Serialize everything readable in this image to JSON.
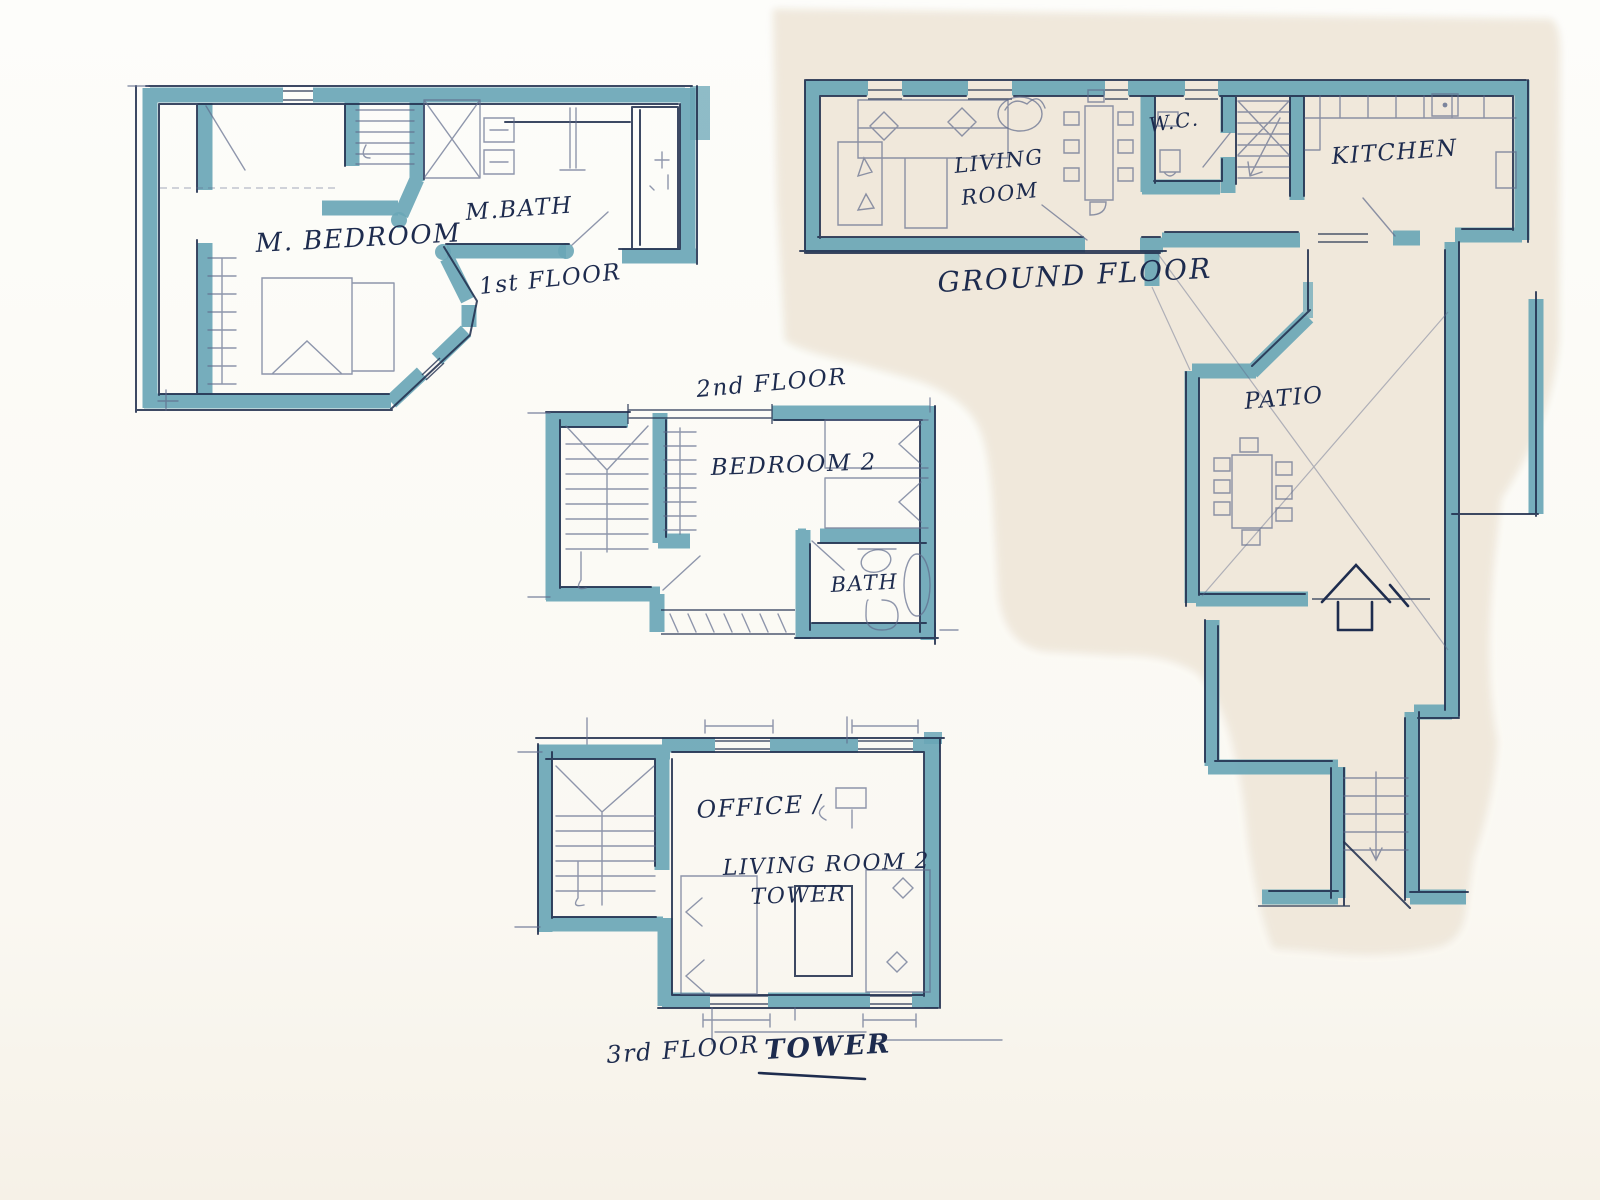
{
  "document": {
    "kind": "hand-sketched watercolor floor plans",
    "colors": {
      "wall_teal": "#6aa6b6",
      "ink": "#22304f",
      "pencil": "#5f6b8c",
      "paper_left": "#fcfbf7",
      "paper_right": "#f0e8db"
    }
  },
  "plans": {
    "first": {
      "caption": "1st FLOOR",
      "rooms": {
        "bedroom": "M. BEDROOM",
        "bath": "M.BATH"
      }
    },
    "second": {
      "caption": "2nd FLOOR",
      "rooms": {
        "bedroom2": "BEDROOM 2",
        "bath": "BATH"
      }
    },
    "third": {
      "caption": "3rd FLOOR",
      "caption2": "TOWER",
      "rooms": {
        "office": "OFFICE /",
        "living2": "LIVING ROOM 2",
        "tower": "TOWER"
      }
    },
    "ground": {
      "caption": "GROUND FLOOR",
      "rooms": {
        "living1": "LIVING",
        "living2": "ROOM",
        "wc": "W.C.",
        "kitchen": "KITCHEN",
        "patio": "PATIO"
      }
    }
  }
}
